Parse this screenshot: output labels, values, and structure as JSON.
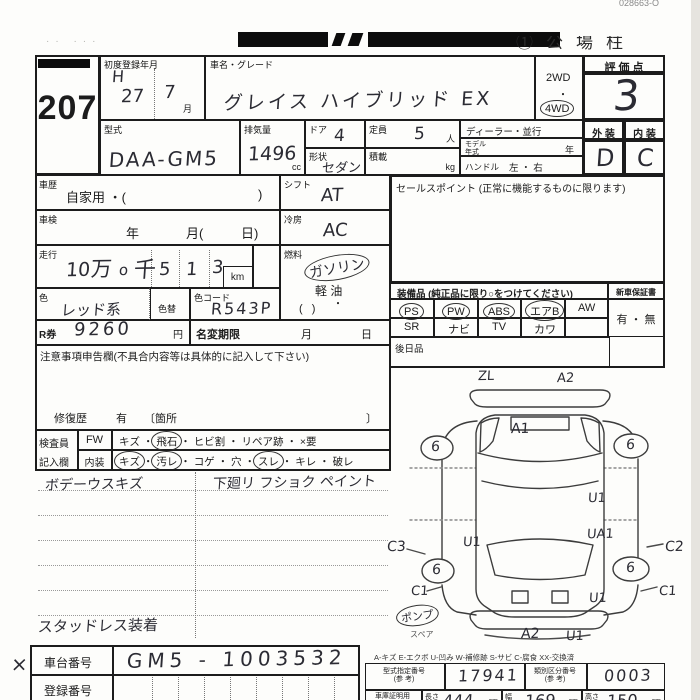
{
  "corner_code": "028663-O",
  "header": {
    "left_marks": "··  ···",
    "stamp": "①公場柱"
  },
  "lot": {
    "number": "207"
  },
  "reg": {
    "label": "初度登録年月",
    "era": "H",
    "year": "27",
    "month": "7",
    "month_unit": "月"
  },
  "name": {
    "label": "車名・グレード",
    "value": "グレイス ハイブリッド EX"
  },
  "drive": {
    "opt1": "2WD",
    "sep": "・",
    "opt2": "4WD"
  },
  "score": {
    "label": "評 価 点",
    "value": "3"
  },
  "model": {
    "label": "型式",
    "value": "DAA-GM5"
  },
  "disp": {
    "label": "排気量",
    "value": "1496",
    "unit": "cc"
  },
  "door": {
    "label": "ドア",
    "value": "4"
  },
  "shape": {
    "label": "形状",
    "value": "セダン"
  },
  "cap": {
    "label": "定員",
    "value": "5",
    "unit": "人"
  },
  "load": {
    "label": "積載",
    "unit": "kg"
  },
  "dealer": {
    "label": "ディーラー・並行"
  },
  "myear": {
    "l1": "モデル",
    "l2": "年式",
    "unit": "年"
  },
  "handle": {
    "label": "ハンドル",
    "value": "左 ・ 右"
  },
  "ext": {
    "label": "外 装",
    "value": "D"
  },
  "int": {
    "label": "内 装",
    "value": "C"
  },
  "hist": {
    "label": "車歴",
    "value": "自家用 ・(",
    "close": ")"
  },
  "shift": {
    "label": "シフト",
    "value": "AT"
  },
  "insp": {
    "label": "車検",
    "v1": "年",
    "v2": "月(",
    "v3": "日)"
  },
  "cool": {
    "label": "冷房",
    "value": "AC"
  },
  "run": {
    "label": "走行",
    "v1": "10",
    "v2": "万",
    "v3": "o",
    "v4": "千",
    "d1": "5",
    "d2": "1",
    "d3": "3",
    "unit": "km"
  },
  "fuel": {
    "label": "燃料",
    "opt1": "ガソリン",
    "opt2": "軽 油",
    "dot": "・",
    "paren": "(        )"
  },
  "color": {
    "label": "色",
    "value": "レッド系"
  },
  "colorchg": {
    "label": "色替"
  },
  "colorcode": {
    "label": "色コード",
    "value": "R543P"
  },
  "rken": {
    "label": "R券",
    "value": "9260",
    "unit": "円"
  },
  "rename": {
    "label": "名変期限",
    "month": "月",
    "day": "日"
  },
  "notes": {
    "label": "注意事項申告欄(不具合内容等は具体的に記入して下さい)",
    "repair": "修復歴",
    "yes": "有",
    "open": "〔箇所",
    "close": "〕"
  },
  "sales": {
    "label": "セールスポイント (正常に機能するものに限ります)"
  },
  "equip": {
    "label": "装備品 (純正品に限り○をつけてください)",
    "r1": [
      "PS",
      "PW",
      "ABS",
      "エアB",
      "AW"
    ],
    "r2": [
      "SR",
      "ナビ",
      "TV",
      "カワ",
      ""
    ],
    "warranty_label": "新車保証書",
    "warranty_value": "有 ・ 無"
  },
  "later": {
    "label": "後日品"
  },
  "check": {
    "label1": "検査員",
    "label2": "記入欄",
    "c1": "FW",
    "c2": "内装",
    "sep": "・",
    "r1": [
      "キズ",
      "飛石",
      "ヒビ割",
      "リペア跡",
      "×要"
    ],
    "r2": [
      "キズ",
      "汚レ",
      "コゲ",
      "穴",
      "スレ",
      "キレ",
      "破レ"
    ]
  },
  "notes_hw": {
    "n1": "ボデーウスキズ",
    "n2": "下廻リ フショク ペイント",
    "n3": "スタッドレス装着",
    "x": "×"
  },
  "chassis": {
    "label": "車台番号",
    "value": "GM5 - 1003532"
  },
  "regno": {
    "label": "登録番号"
  },
  "legend": "A-キズ  E-エクボ  U-凹み  W-補修跡  S-サビ  C-腐食  XX-交換済",
  "ref": {
    "l1a": "型式指定番号",
    "l1b": "(参 考)",
    "v1": "17941",
    "l2a": "類別区分番号",
    "l2b": "(参 考)",
    "v2": "0003",
    "l3a": "車庫証明用",
    "l3b": "(参 考)",
    "len_label": "長さ",
    "len": "444",
    "wid_label": "幅",
    "wid": "169",
    "hgt_label": "高さ",
    "hgt": "150",
    "unit": "cm"
  },
  "diagram": {
    "a": [
      {
        "t": "ZL"
      },
      {
        "t": "A2"
      },
      {
        "t": "A1"
      },
      {
        "t": "6"
      },
      {
        "t": "6"
      },
      {
        "t": "U1"
      },
      {
        "t": "U1"
      },
      {
        "t": "UA1"
      },
      {
        "t": "C3"
      },
      {
        "t": "C2"
      },
      {
        "t": "6"
      },
      {
        "t": "6"
      },
      {
        "t": "C1"
      },
      {
        "t": "C1"
      },
      {
        "t": "U1"
      },
      {
        "t": "ポンプ"
      },
      {
        "t": "スペア"
      },
      {
        "t": "A2"
      },
      {
        "t": "U1"
      }
    ]
  }
}
